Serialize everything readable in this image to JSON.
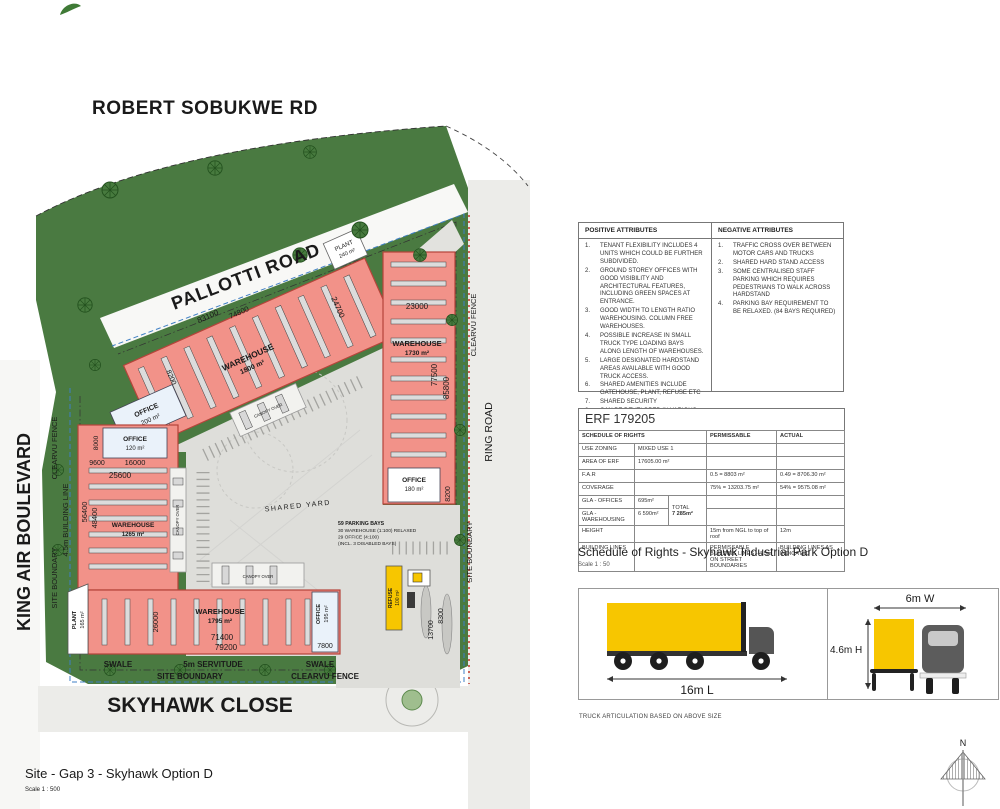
{
  "colors": {
    "building_fill": "#F29289",
    "building_outline": "#B5443A",
    "landscape_green": "#4A7A41",
    "truck_yellow": "#F7C600",
    "boundary_blue": "#3F7FC4",
    "fence_red": "#C23328"
  },
  "plan": {
    "roads": {
      "robert": "ROBERT SOBUKWE RD",
      "pallotti": "PALLOTTI ROAD",
      "king_air": "KING AIR BOULEVARD",
      "skyhawk": "SKYHAWK CLOSE",
      "ring": "RING ROAD"
    },
    "boundary": {
      "left_boundary": "SITE BOUNDARY",
      "left_fence": "CLEARVU FENCE",
      "left_building_line": "4.5m BUILDING LINE",
      "right_fence": "CLEARVU FENCE",
      "right_boundary": "SITE BOUNDARY",
      "swale_left": "SWALE",
      "servitude": "5m SERVITUDE",
      "swale_right": "SWALE",
      "bottom_boundary": "SITE BOUNDARY",
      "bottom_fence": "CLEARVU FENCE"
    },
    "buildings": {
      "wh_north": {
        "label": "WAREHOUSE",
        "area": "1800 m²"
      },
      "office200": {
        "label": "OFFICE",
        "area": "200 m²"
      },
      "plant240": {
        "label": "PLANT",
        "area": "240 m²"
      },
      "wh_east": {
        "label": "WAREHOUSE",
        "area": "1730 m²"
      },
      "office180": {
        "label": "OFFICE",
        "area": "180 m²"
      },
      "wh_west": {
        "label": "WAREHOUSE",
        "area": "1265 m²"
      },
      "office120": {
        "label": "OFFICE",
        "area": "120 m²"
      },
      "wh_south": {
        "label": "WAREHOUSE",
        "area": "1795 m²"
      },
      "office195": {
        "label": "OFFICE",
        "area": "195 m²"
      },
      "plant165": {
        "label": "PLANT",
        "area": "165 m²"
      },
      "refuse": {
        "label": "REFUSE",
        "area": "100 m²"
      }
    },
    "dims": {
      "north_a": "83100",
      "north_b": "74800",
      "north_c": "24700",
      "east_w": "23000",
      "east_h1": "77500",
      "east_h2": "85800",
      "office180_d": "8200",
      "office200_d": "8200",
      "west_a": "9600",
      "west_b": "16000",
      "west_c": "25600",
      "west_d": "8000",
      "west_h1": "56400",
      "west_h2": "48400",
      "south_h": "26000",
      "south_a": "71400",
      "south_b": "79200",
      "office195_d": "7800",
      "gate_a": "13700",
      "gate_b": "8300"
    },
    "notes": {
      "shared_yard": "SHARED YARD",
      "canopy_north": "CANOPY OVER",
      "canopy_west": "CANOPY OVER",
      "canopy_south": "CANOPY OVER",
      "parking_title": "59 PARKING BAYS",
      "parking_line1": "30 WAREHOUSE (1:100) RELAXED",
      "parking_line2": "29 OFFICE (4:100)",
      "parking_line3": "(INCL. 3 DISABLED BAYS)"
    },
    "title": "Site - Gap 3 - Skyhawk Option D",
    "scale": "Scale 1 : 500",
    "compass": "N"
  },
  "attributes": {
    "positive": {
      "header": "POSITIVE ATTRIBUTES",
      "items": [
        {
          "n": "1.",
          "t": "TENANT FLEXIBILITY INCLUDES 4 UNITS WHICH COULD BE FURTHER SUBDIVIDED."
        },
        {
          "n": "2.",
          "t": "GROUND STOREY OFFICES WITH GOOD VISIBILITY AND ARCHITECTURAL FEATURES, INCLUDING GREEN SPACES AT ENTRANCE."
        },
        {
          "n": "3.",
          "t": "GOOD WIDTH TO LENGTH RATIO WAREHOUSING. COLUMN FREE WAREHOUSES."
        },
        {
          "n": "4.",
          "t": "POSSIBLE INCREASE IN SMALL TRUCK TYPE LOADING BAYS ALONG LENGTH OF WAREHOUSES."
        },
        {
          "n": "5.",
          "t": "LARGE DESIGNATED HARDSTAND AREAS AVAILABLE WITH GOOD TRUCK ACCESS."
        },
        {
          "n": "6.",
          "t": "SHARED AMENITIES INCLUDE GATEHOUSE, PLANT, REFUSE ETC"
        },
        {
          "n": "7.",
          "t": "SHARED SECURITY"
        },
        {
          "n": "8.",
          "t": "CAN BE DEVELOPED IN VARIOUS PHASES"
        }
      ]
    },
    "negative": {
      "header": "NEGATIVE ATTRIBUTES",
      "items": [
        {
          "n": "1.",
          "t": "TRAFFIC CROSS OVER BETWEEN MOTOR CARS AND TRUCKS"
        },
        {
          "n": "2.",
          "t": "SHARED HARD STAND ACCESS"
        },
        {
          "n": "3.",
          "t": "SOME CENTRALISED STAFF PARKING WHICH REQUIRES PEDESTRIANS TO WALK ACROSS HARDSTAND"
        },
        {
          "n": "4.",
          "t": "PARKING BAY REQUIREMENT TO BE RELAXED. (84 BAYS REQUIRED)"
        }
      ]
    }
  },
  "erf": {
    "title": "ERF 179205",
    "col_rights": "SCHEDULE OF RIGHTS",
    "col_perm": "PERMISSABLE",
    "col_act": "ACTUAL",
    "rows": {
      "zoning": {
        "label": "USE ZONING",
        "value": "MIXED USE 1"
      },
      "area": {
        "label": "AREA OF ERF",
        "value": "17605.00 m²"
      },
      "far": {
        "label": "F.A.R",
        "perm": "0.5  =  8803 m²",
        "act": "0.49  =  8706.30 m²"
      },
      "coverage": {
        "label": "COVERAGE",
        "perm": "75%  =  13203.75 m²",
        "act": "54%  =  9575.08 m²"
      },
      "gla_off": {
        "label": "GLA - OFFICES",
        "value": "695m²"
      },
      "gla_wh": {
        "label": "GLA - WAREHOUSING",
        "value": "6 590m²"
      },
      "total_label": "TOTAL",
      "total_value": "7 285m²",
      "height": {
        "label": "HEIGHT",
        "perm": "15m from NGL to top of roof",
        "act": "12m"
      },
      "lines": {
        "label": "BUILDING LINES",
        "perm": "PERMISSABLE BUILDING LINES - 4.5m ON STREET BOUNDARIES",
        "act": "BUILDING LINES AS INDICATED"
      }
    },
    "caption": "Schedule of Rights - Skyhawk Industrial Park Option D",
    "caption_scale": "Scale 1 : 50"
  },
  "truck": {
    "length": "16m L",
    "width": "6m W",
    "height": "4.6m H",
    "note": "TRUCK ARTICULATION BASED ON ABOVE SIZE"
  }
}
